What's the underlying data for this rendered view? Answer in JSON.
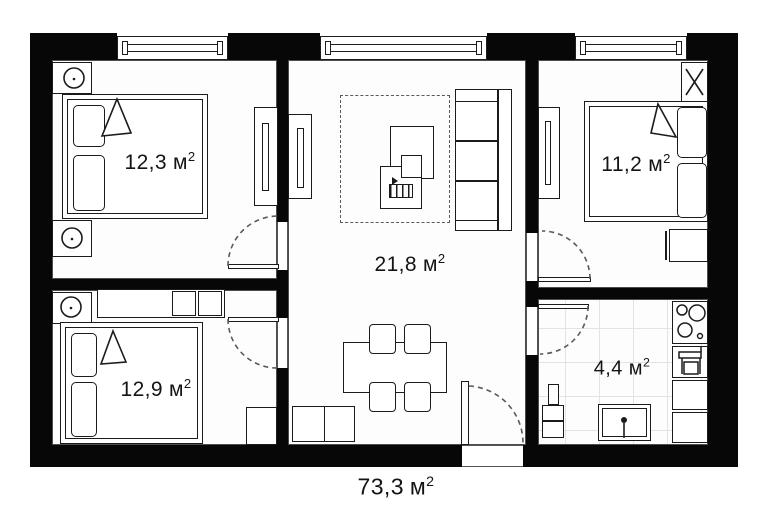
{
  "plan": {
    "rooms": {
      "bedroom_top_left": {
        "area": "12,3",
        "unit": "м",
        "sup": "2"
      },
      "bedroom_top_right": {
        "area": "11,2",
        "unit": "м",
        "sup": "2"
      },
      "living_room": {
        "area": "21,8",
        "unit": "м",
        "sup": "2"
      },
      "bedroom_bottom_left": {
        "area": "12,9",
        "unit": "м",
        "sup": "2"
      },
      "kitchen": {
        "area": "4,4",
        "unit": "м",
        "sup": "2"
      }
    },
    "total": {
      "area": "73,3",
      "unit": "м",
      "sup": "2"
    },
    "colors": {
      "wall": "#070707",
      "furniture_line": "#1b1b1b",
      "dashed_line": "#5a5a5a",
      "tile_line": "#e3e3e3",
      "background": "#ffffff"
    }
  }
}
